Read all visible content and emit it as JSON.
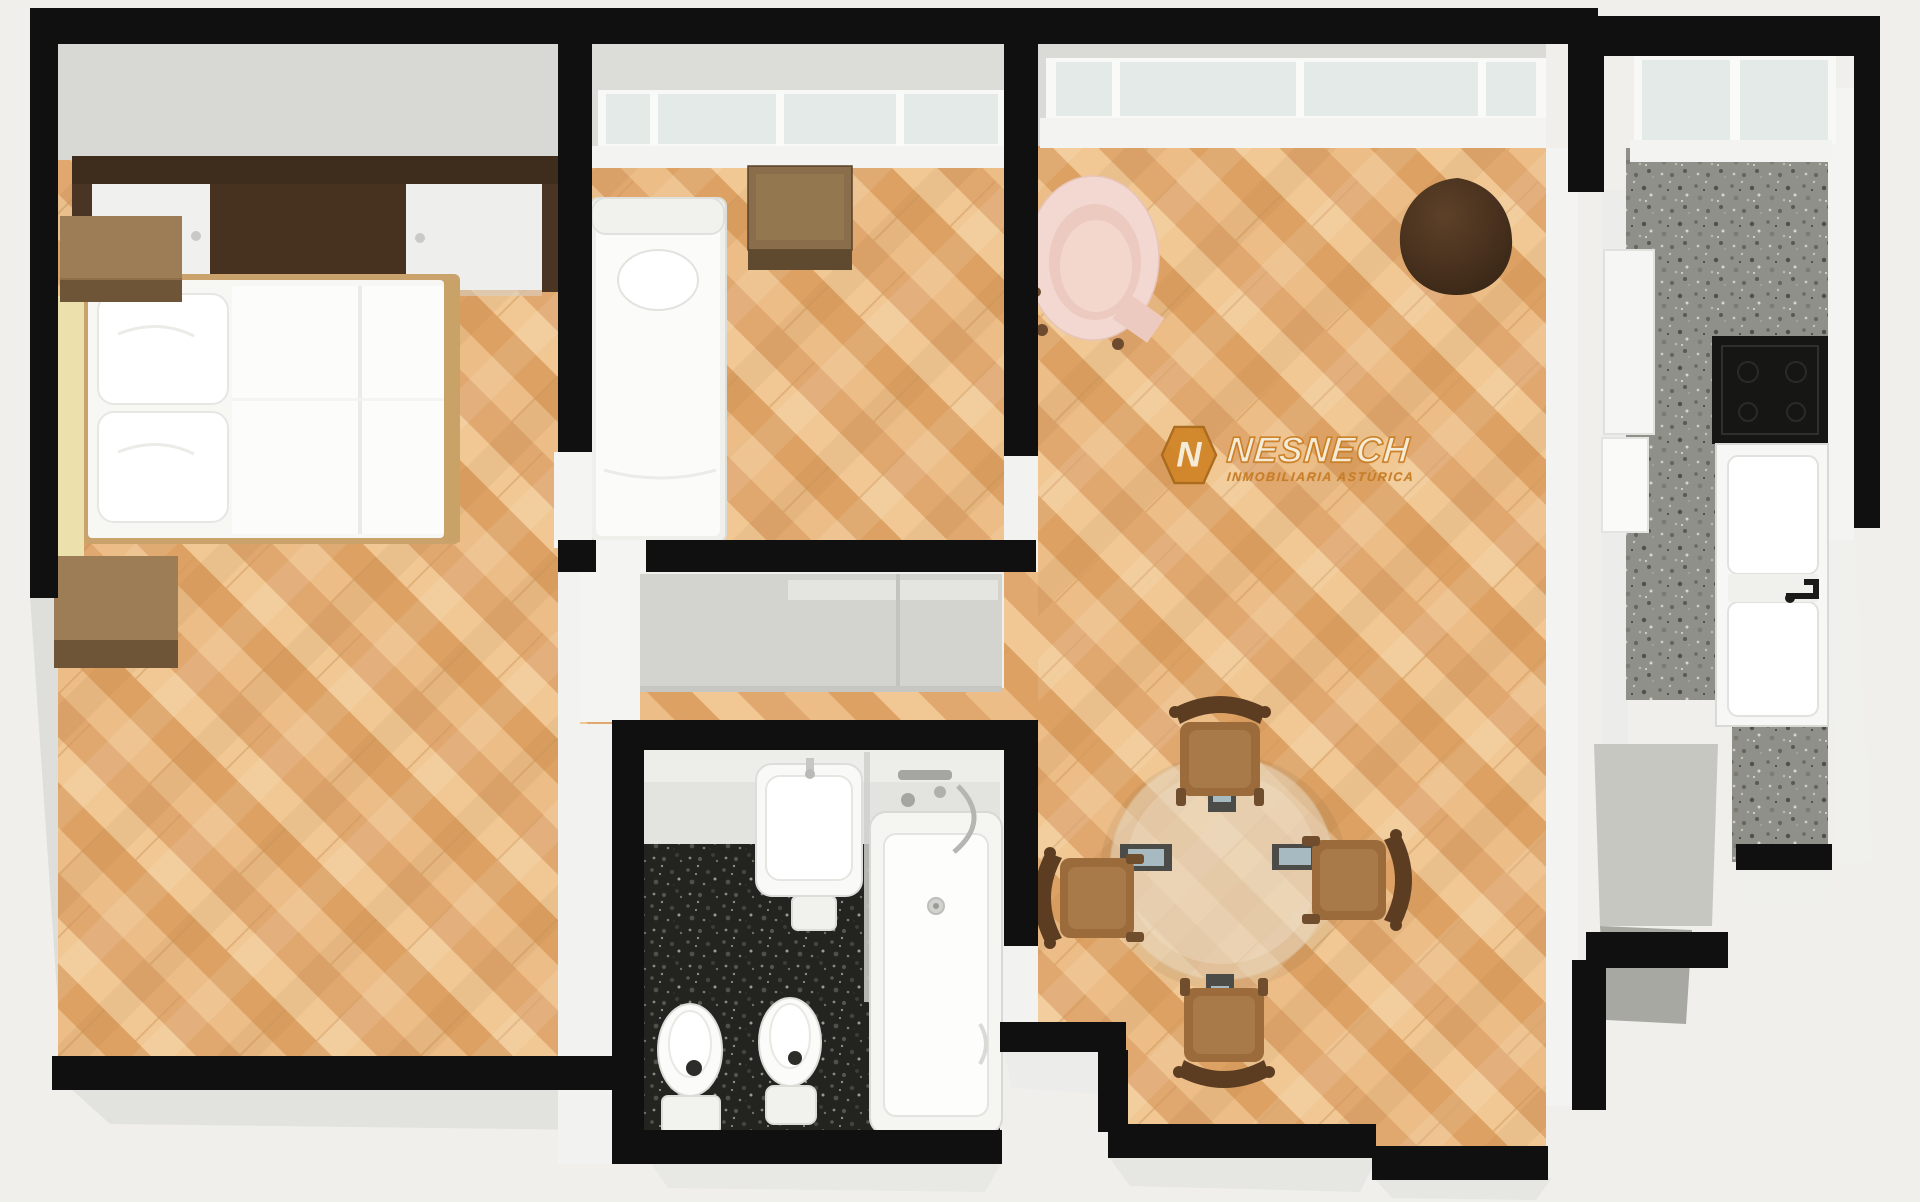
{
  "watermark": {
    "brand": "NESNECH",
    "tagline": "INMOBILIARIA ASTÚRICA",
    "initial": "N"
  },
  "palette": {
    "background": "#f0efec",
    "wall_black": "#101010",
    "wall_face_gray": "#d8d8d5",
    "wall_face_white": "#f3f3f1",
    "wood_floor": "#e9b77f",
    "wood_floor_light": "#f1c894",
    "wood_floor_dark": "#dda263",
    "bathroom_floor": "#23231f",
    "kitchen_floor": "#90908a",
    "window_glass": "#e4eae8",
    "logo_orange": "#d2862a",
    "logo_cream": "#f6eedb",
    "bed_white": "#fbfbf9",
    "furniture_brown": "#9b6b3c",
    "furniture_dark_brown": "#5d3d21",
    "armchair_pink": "#f2d8d0",
    "pouf_brown": "#47301d",
    "table_glass": "#ecdcc4"
  },
  "rooms": [
    {
      "id": "bedroom-1",
      "furniture": [
        "wardrobe",
        "double-bed",
        "nightstand-a",
        "nightstand-b"
      ]
    },
    {
      "id": "bedroom-2",
      "furniture": [
        "single-bed",
        "bedside-cube"
      ]
    },
    {
      "id": "hallway",
      "furniture": [
        "built-in-closet"
      ]
    },
    {
      "id": "bathroom",
      "furniture": [
        "vanity-counter",
        "washbasin",
        "bathtub",
        "toilet",
        "bidet"
      ]
    },
    {
      "id": "living-dining-room",
      "furniture": [
        "armchair",
        "pouf",
        "round-dining-table",
        "dining-chair-north",
        "dining-chair-south",
        "dining-chair-west",
        "dining-chair-east"
      ]
    },
    {
      "id": "kitchen",
      "furniture": [
        "counter",
        "cooktop",
        "sink"
      ]
    }
  ]
}
